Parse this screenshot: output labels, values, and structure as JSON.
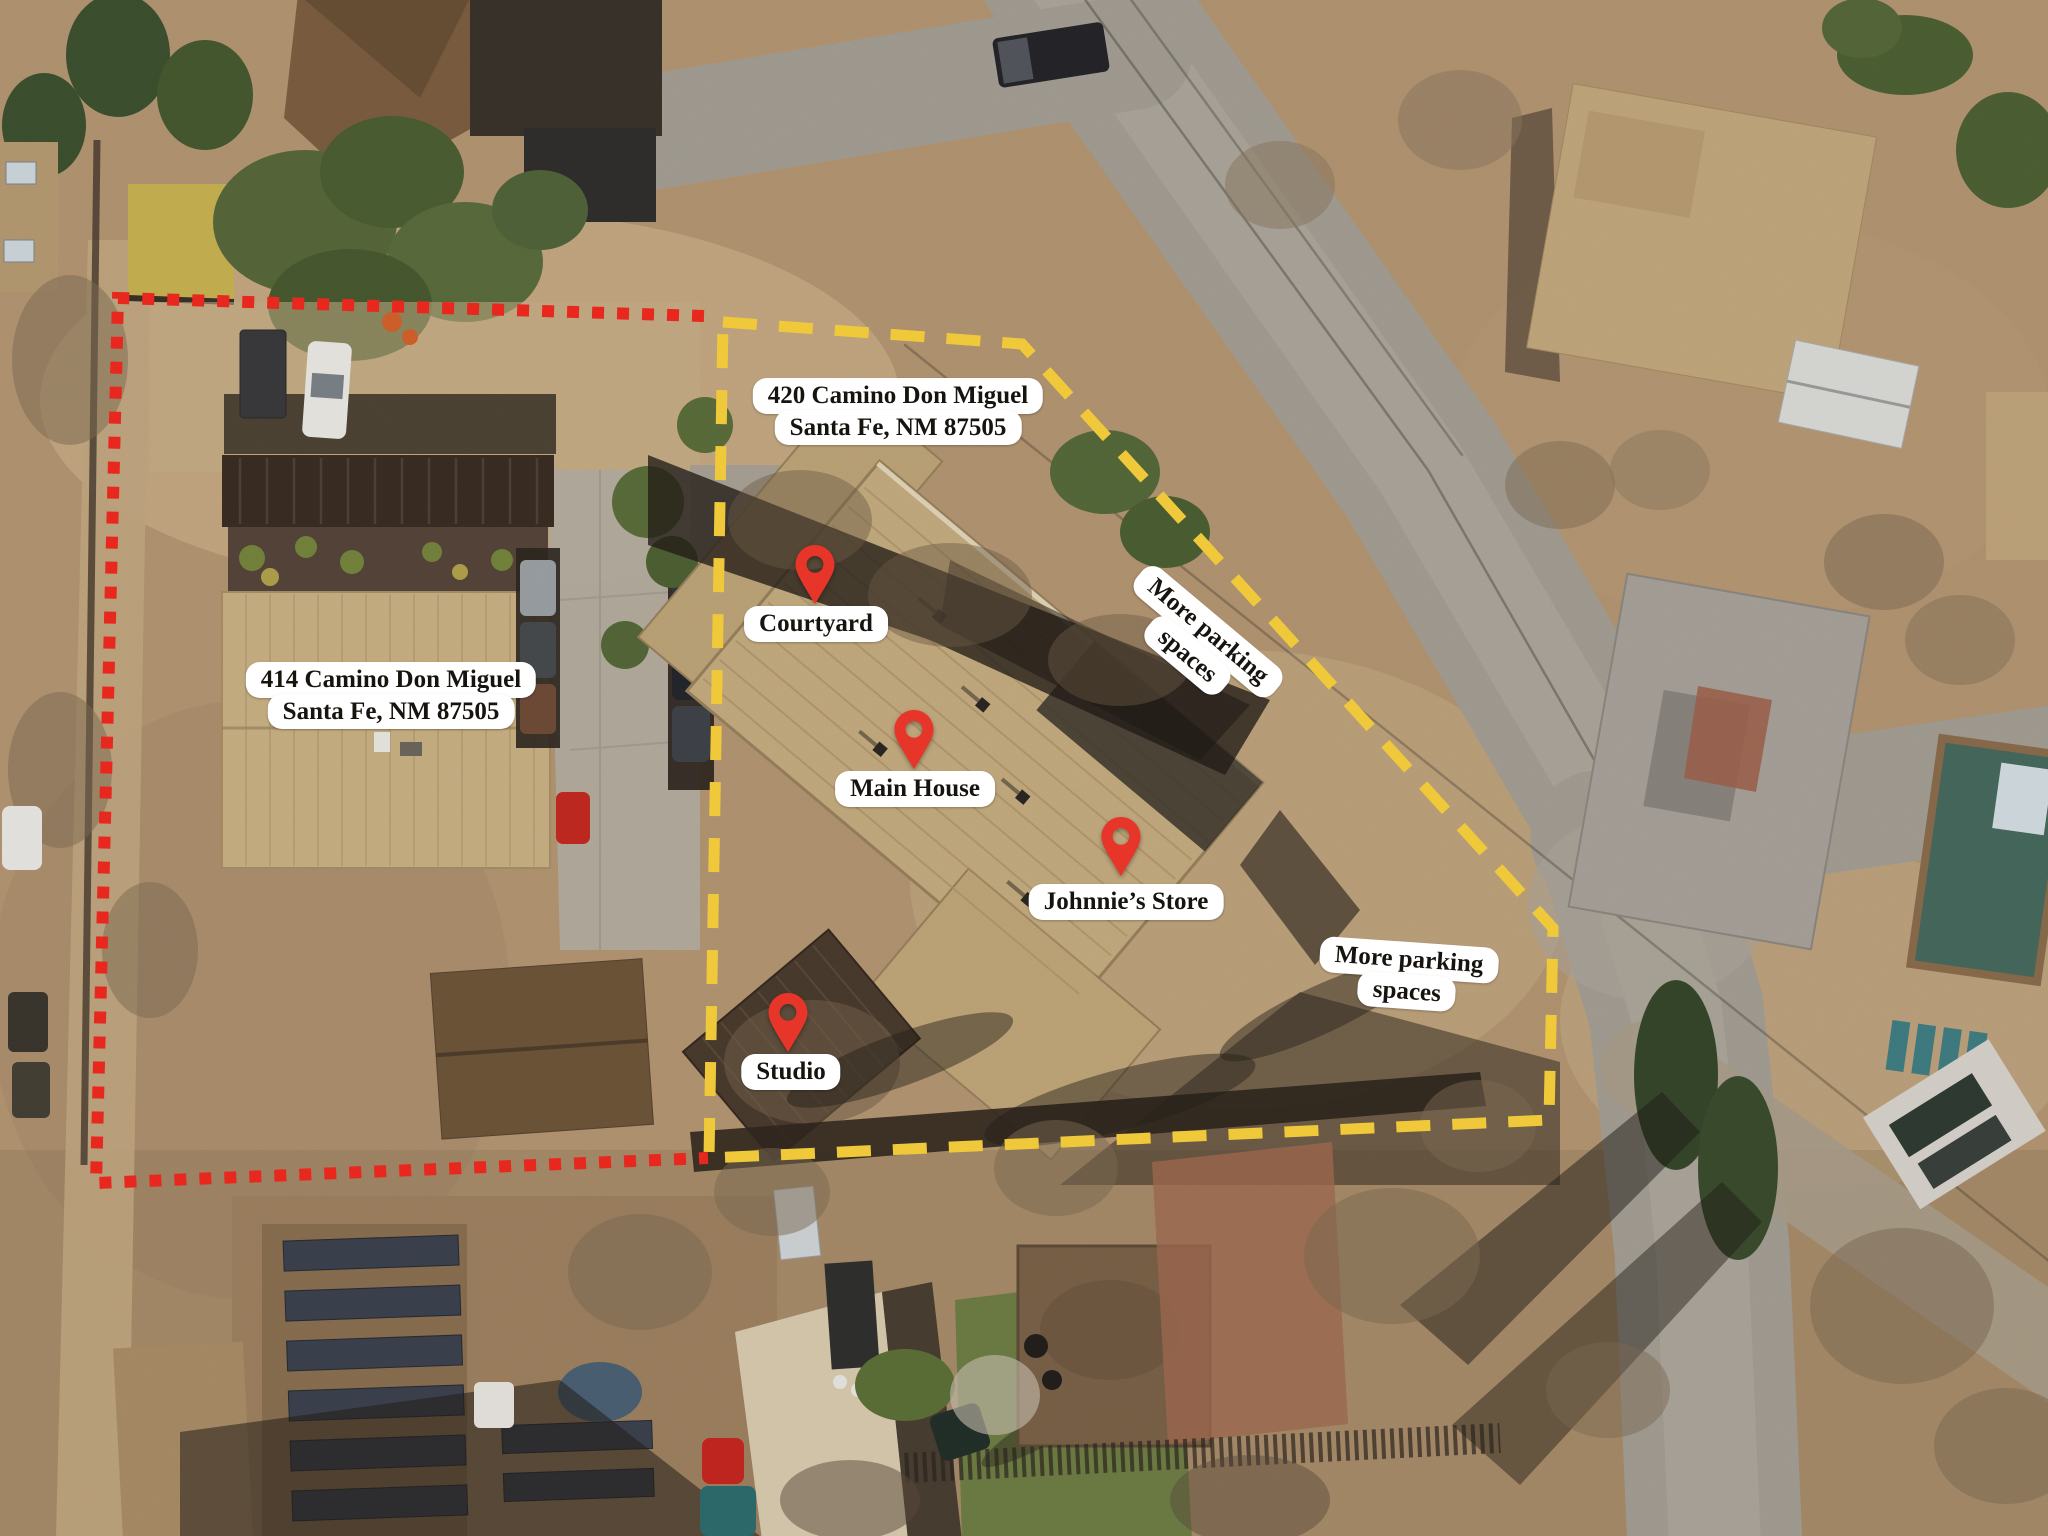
{
  "labels": {
    "address_420": {
      "line1": "420 Camino Don Miguel",
      "line2": "Santa Fe, NM 87505"
    },
    "address_414": {
      "line1": "414 Camino Don Miguel",
      "line2": "Santa Fe, NM 87505"
    },
    "pins": [
      {
        "id": "courtyard",
        "label": "Courtyard"
      },
      {
        "id": "main-house",
        "label": "Main House"
      },
      {
        "id": "johnnies-store",
        "label": "Johnnie’s Store"
      },
      {
        "id": "studio",
        "label": "Studio"
      }
    ],
    "parking_ne": {
      "line1": "More parking",
      "line2": "spaces"
    },
    "parking_se": {
      "line1": "More parking",
      "line2": "spaces"
    }
  },
  "colors": {
    "boundary_420_yellow": "#F0C93B",
    "boundary_414_red": "#E8281E",
    "pin_red": "#E73529",
    "label_bg": "#FFFFFF",
    "label_text": "#17140F"
  }
}
